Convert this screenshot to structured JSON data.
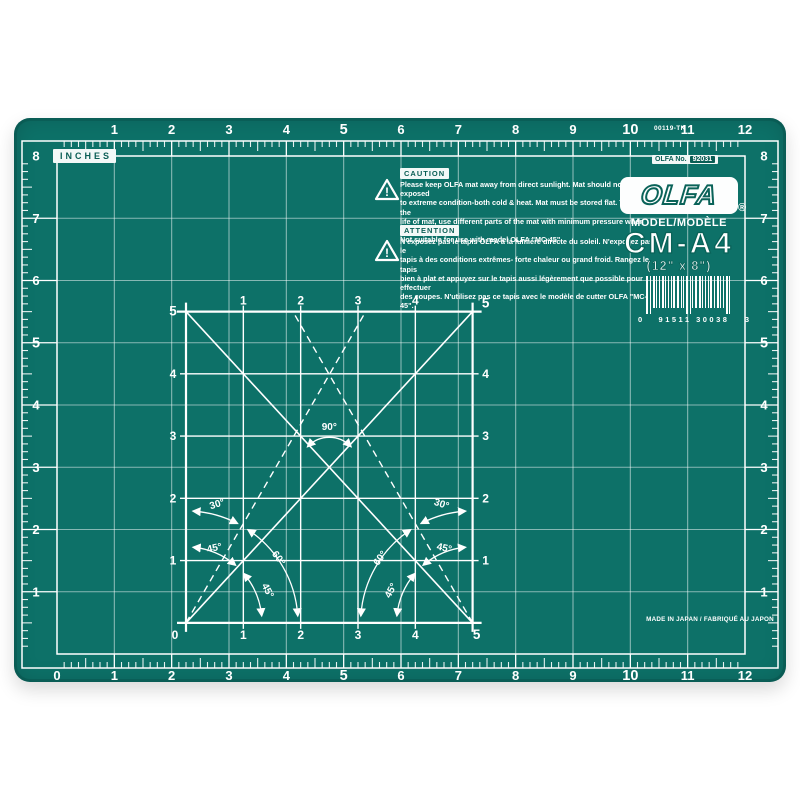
{
  "colors": {
    "mat_surface": "#0d7168",
    "mat_edge": "#0a5e55",
    "grid_line": "#ffffff",
    "label_teal": "#0a5e55"
  },
  "mat": {
    "inches_label": "INCHES",
    "part_code": "00119-TK",
    "made_in": "MADE IN JAPAN / FABRIQUÉ AU JAPON",
    "rulers": {
      "top": [
        "1",
        "2",
        "3",
        "4",
        "5",
        "6",
        "7",
        "8",
        "9",
        "10",
        "11",
        "12"
      ],
      "bottom": [
        "0",
        "1",
        "2",
        "3",
        "4",
        "5",
        "6",
        "7",
        "8",
        "9",
        "10",
        "11",
        "12"
      ],
      "left": [
        "8",
        "7",
        "6",
        "5",
        "4",
        "3",
        "2",
        "1"
      ],
      "right": [
        "8",
        "7",
        "6",
        "5",
        "4",
        "3",
        "2",
        "1"
      ],
      "bold": [
        "5",
        "10"
      ]
    },
    "caution": {
      "title": "CAUTION",
      "lines": [
        "Please keep OLFA mat away from direct sunlight. Mat should not be exposed",
        "to extreme condition-both cold & heat. Mat must be stored flat. To extend the",
        "life of mat, use different parts of the mat with minimum pressure when cutting.",
        "Not suitable for use with model OLFA \"MC-45\"."
      ]
    },
    "attention": {
      "title": "ATTENTION",
      "lines": [
        "N'exposez pas le tapis OLFA à la lumière directe du soleil. N'exposez pas le",
        "tapis à des conditions extrêmes- forte chaleur ou grand froid. Rangez le tapis",
        "bien à plat et appuyez sur le tapis aussi légèrement que possible pour effectuer",
        "des coupes. N'utilisez pas ce tapis avec le modèle de cutter OLFA \"MC-45\"."
      ]
    },
    "brand": {
      "no_label": "OLFA No.",
      "no_value": "92031",
      "logo": "OLFA",
      "registered": "®",
      "model_label": "MODEL/MODÈLE",
      "model": "CM-A4",
      "size": "(12\" x 8\")"
    },
    "barcode": {
      "left": "0",
      "center": "91511 30038",
      "right": "3"
    },
    "square": {
      "top": [
        "1",
        "2",
        "3",
        "4"
      ],
      "left": [
        "5",
        "4",
        "3",
        "2",
        "1"
      ],
      "right": [
        "5",
        "4",
        "3",
        "2",
        "1"
      ],
      "bottom": [
        "0",
        "1",
        "2",
        "3",
        "4",
        "5"
      ],
      "angles": {
        "deg90": "90°",
        "deg60": "60°",
        "deg45": "45°",
        "deg30": "30°"
      }
    }
  }
}
